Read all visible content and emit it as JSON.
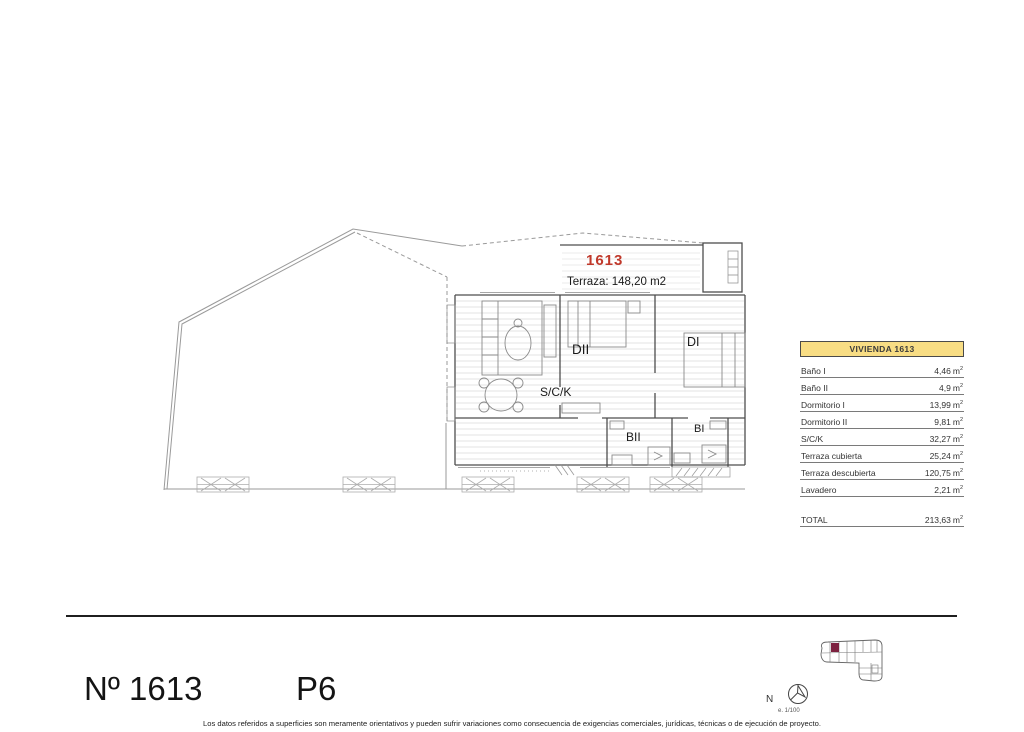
{
  "page": {
    "title": "Nº 1613",
    "floor": "P6",
    "north_letter": "N",
    "scale_note": "e. 1/100",
    "disclaimer": "Los datos referidos a superficies son meramente orientativos y pueden sufrir variaciones como consecuencia de exigencias comerciales, jurídicas, técnicas o de ejecución de proyecto."
  },
  "plan": {
    "unit_number": "1613",
    "terrace_note": "Terraza: 148,20 m2",
    "rooms": [
      {
        "label": "S/C/K"
      },
      {
        "label": "DII"
      },
      {
        "label": "DI"
      },
      {
        "label": "BII"
      },
      {
        "label": "BI"
      }
    ]
  },
  "table": {
    "header": "VIVIENDA 1613",
    "unit": "m",
    "unit_sup": "2",
    "rows": [
      {
        "label": "Baño I",
        "value": "4,46"
      },
      {
        "label": "Baño II",
        "value": "4,9"
      },
      {
        "label": "Dormitorio I",
        "value": "13,99"
      },
      {
        "label": "Dormitorio II",
        "value": "9,81"
      },
      {
        "label": "S/C/K",
        "value": "32,27"
      },
      {
        "label": "Terraza cubierta",
        "value": "25,24"
      },
      {
        "label": "Terraza descubierta",
        "value": "120,75"
      },
      {
        "label": "Lavadero",
        "value": "2,21"
      }
    ],
    "total": {
      "label": "TOTAL",
      "value": "213,63"
    }
  },
  "colors": {
    "accent_red": "#c0392b",
    "table_header_bg": "#f8dd84",
    "locator_highlight": "#7d2240"
  }
}
